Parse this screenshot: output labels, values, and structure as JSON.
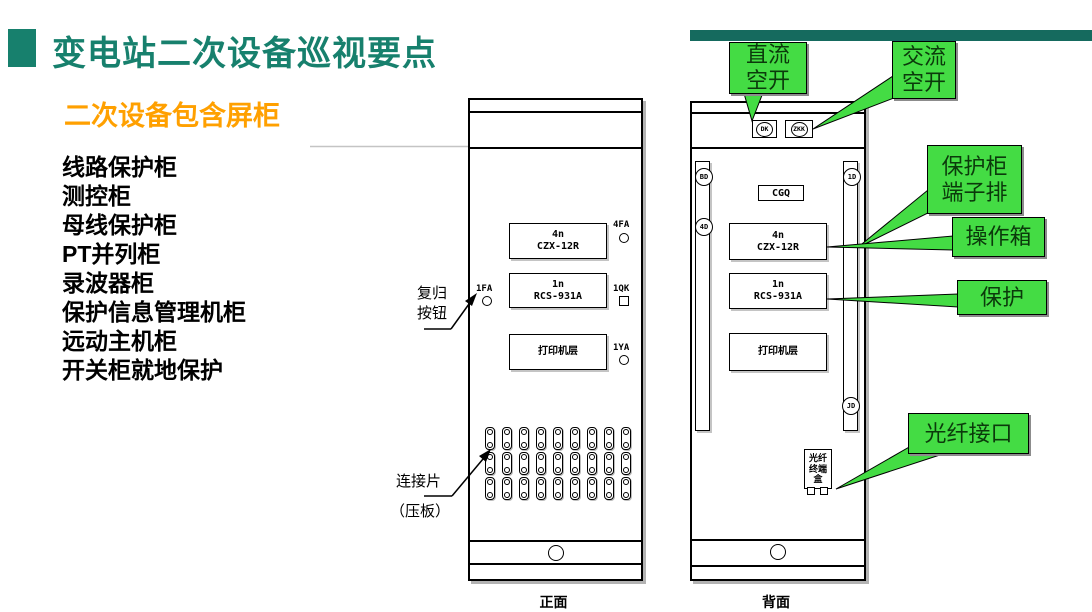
{
  "slide_title": "变电站二次设备巡视要点",
  "subtitle": "二次设备包含屏柜",
  "cabinet_list": [
    "线路保护柜",
    "测控柜",
    "母线保护柜",
    "PT并列柜",
    "录波器柜",
    "保护信息管理机柜",
    "远动主机柜",
    "开关柜就地保护"
  ],
  "callouts": {
    "dc_breaker_line1": "直流",
    "dc_breaker_line2": "空开",
    "ac_breaker_line1": "交流",
    "ac_breaker_line2": "空开",
    "terminal_line1": "保护柜",
    "terminal_line2": "端子排",
    "operation_box": "操作箱",
    "protection": "保护",
    "fiber_port": "光纤接口"
  },
  "front_cabinet": {
    "caption": "正面",
    "module1_line1": "4n",
    "module1_line2": "CZX-12R",
    "module2_line1": "1n",
    "module2_line2": "RCS-931A",
    "module3": "打印机层",
    "ind_top_right": "4FA",
    "ind_left": "1FA",
    "ind_mid_right": "1QK",
    "ind_bottom_right": "1YA",
    "pressure_plates": {
      "rows": 3,
      "cols": 9
    }
  },
  "back_cabinet": {
    "caption": "背面",
    "dc_breaker_label": "DK",
    "ac_breaker_label": "ZKK",
    "left_strip_top": "BD",
    "left_strip_mid": "4D",
    "right_strip_top": "1D",
    "right_strip_bottom": "JD",
    "sensor_box": "CGQ",
    "module1_line1": "4n",
    "module1_line2": "CZX-12R",
    "module2_line1": "1n",
    "module2_line2": "RCS-931A",
    "module3": "打印机层",
    "fiber_box_line1": "光纤",
    "fiber_box_line2": "终端",
    "fiber_box_line3": "盒"
  },
  "annotations": {
    "reset_line1": "复归",
    "reset_line2": "按钮",
    "plates_label": "连接片",
    "plates_sub": "（压板）"
  },
  "colors": {
    "title_teal": "#17806D",
    "top_bar_teal": "#156A5E",
    "subtitle_orange": "#FFA000",
    "callout_green": "#44DC44",
    "callout_text": "#0B3A0B"
  }
}
